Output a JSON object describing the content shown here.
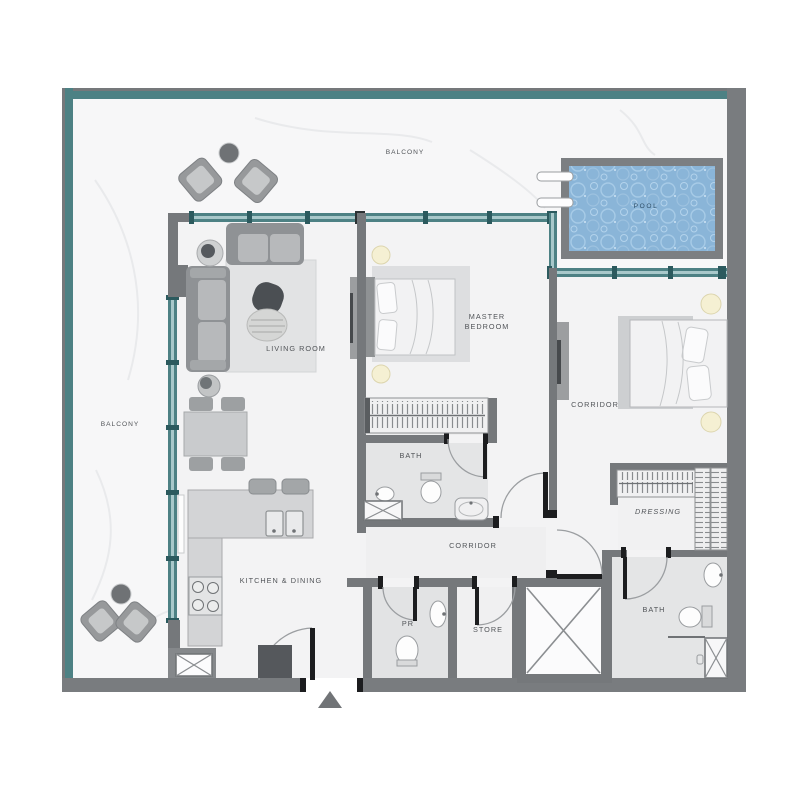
{
  "plan": {
    "type": "apartment-floor-plan",
    "labels": {
      "balcony_top": "BALCONY",
      "balcony_left": "BALCONY",
      "pool": "POOL",
      "living_room": "LIVING ROOM",
      "master_line1": "MASTER",
      "master_line2": "BEDROOM",
      "corridor_upper": "CORRIDOR",
      "bath_master": "BATH",
      "corridor_main": "CORRIDOR",
      "kitchen": "KITCHEN & DINING",
      "pr": "PR",
      "store": "STORE",
      "dressing": "DRESSING",
      "bath_second": "BATH"
    },
    "colors": {
      "wall_teal": "#4d8184",
      "wall_gray": "#797c7f",
      "glazing_light": "#a8c8ca",
      "pool_water": "#8ab5d8",
      "pool_frame": "#7c7f82",
      "floor_interior": "#f3f3f4",
      "floor_balcony": "#f7f7f8",
      "floor_wet": "#e4e5e6",
      "label_text": "#515458",
      "door_leaf": "#1c1d1f"
    }
  }
}
